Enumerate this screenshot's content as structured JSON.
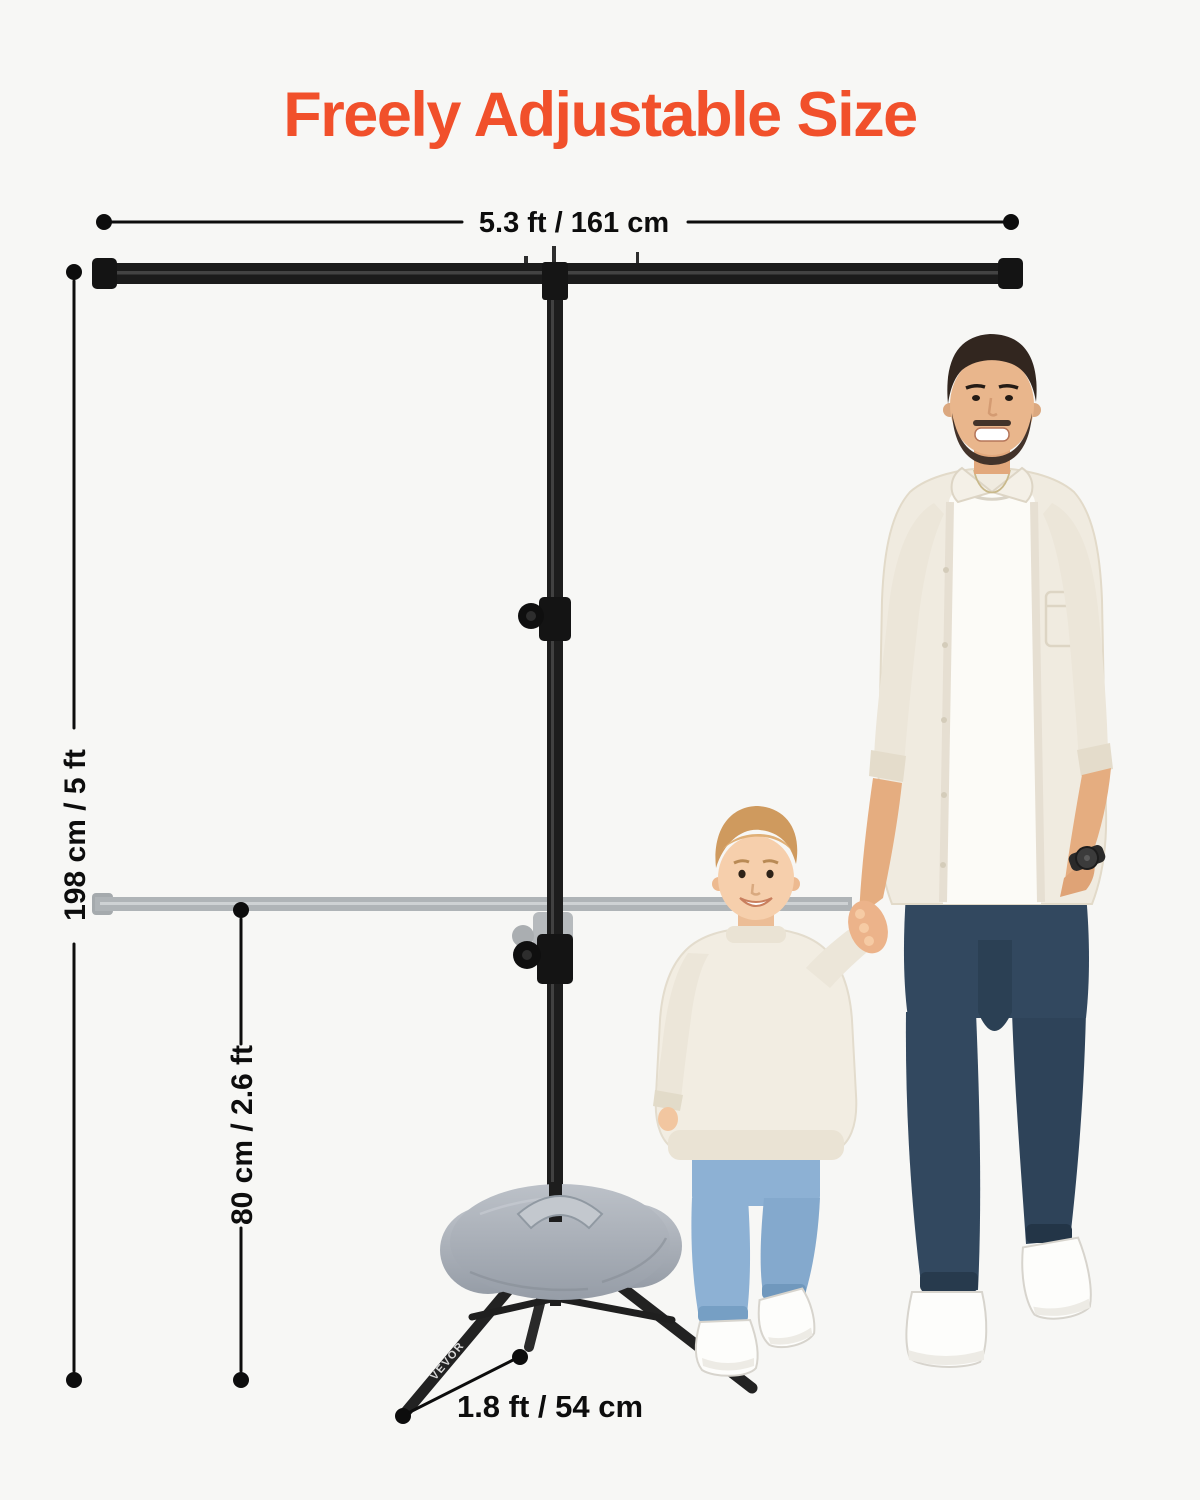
{
  "title": {
    "text": "Freely Adjustable Size"
  },
  "dimensions": {
    "crossbar_width_label": "5.3 ft / 161 cm",
    "stand_height_label": "198 cm / 5 ft",
    "lowered_crossbar_height_label": "80 cm / 2.6 ft",
    "tripod_leg_label": "1.8 ft / 54 cm"
  },
  "brand": {
    "leg_print": "VEVOR"
  },
  "colors": {
    "accent_orange": "#F1502B",
    "dimension_black": "#0d0d0d",
    "stand_black": "#1b1b1b",
    "ghost_gray": "#a6abaf",
    "sandbag_gray": "#a8aeb6",
    "background": "#f7f7f5"
  }
}
